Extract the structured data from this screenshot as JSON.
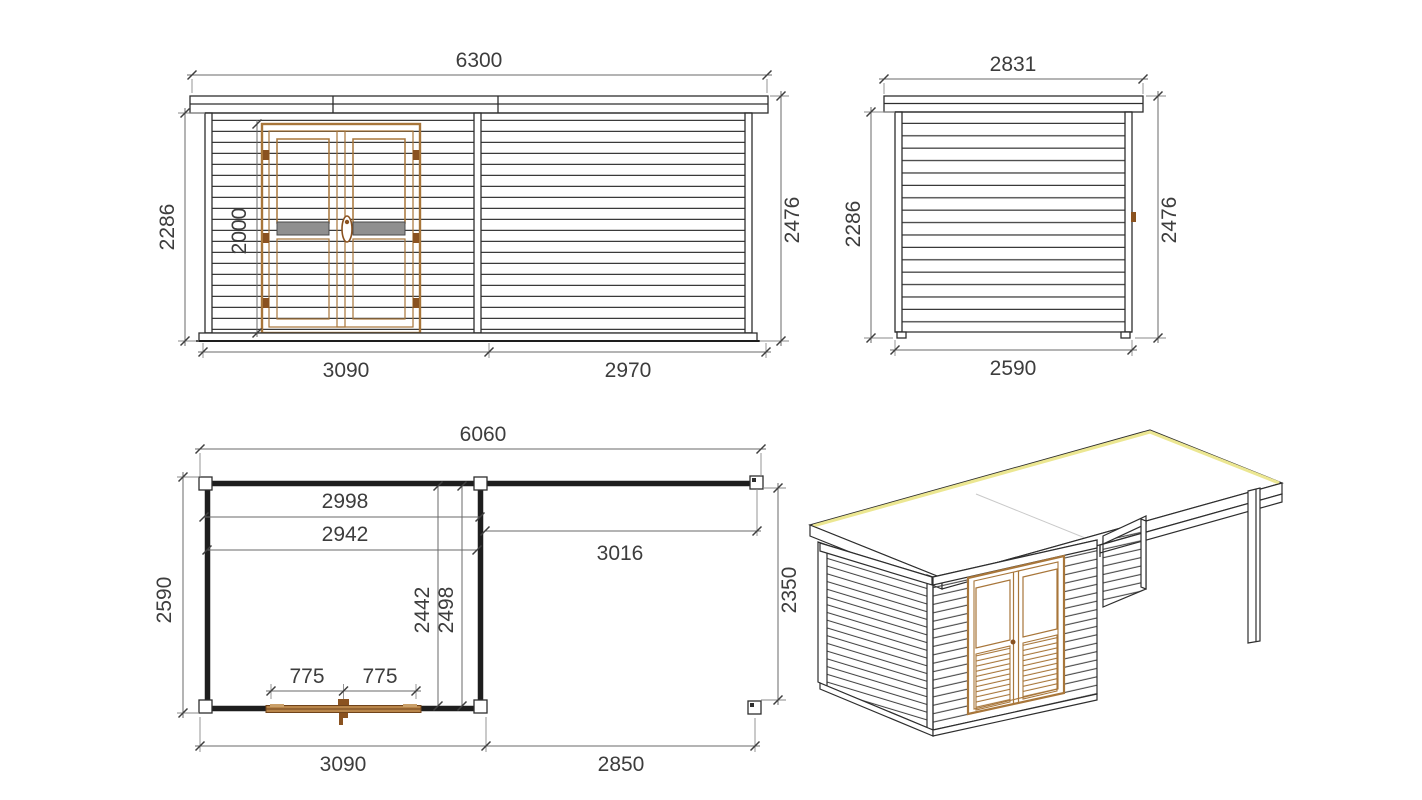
{
  "drawing_title": "Garden cabin with side canopy — dimension drawing",
  "views": {
    "front": {
      "label": "front-elevation",
      "overall_width": "6300",
      "wall_height": "2286",
      "door_height": "2000",
      "total_height": "2476",
      "cabin_width": "3090",
      "canopy_width": "2970"
    },
    "side": {
      "label": "side-elevation",
      "roof_depth": "2831",
      "wall_height": "2286",
      "total_height": "2476",
      "base_depth": "2590"
    },
    "plan": {
      "label": "floor-plan",
      "overall_width": "6060",
      "cabin_width_incl_wall": "2998",
      "cabin_inner_width": "2942",
      "canopy_inner_width": "3016",
      "depth": "2590",
      "cabin_inner_depth": "2442",
      "cabin_depth_incl_wall": "2498",
      "canopy_depth": "2350",
      "door_leaf_left": "775",
      "door_leaf_right": "775",
      "cabin_width_bottom": "3090",
      "canopy_width_bottom": "2850"
    },
    "iso": {
      "label": "isometric-view"
    }
  },
  "colors": {
    "background": "#ffffff",
    "line": "#2e2e2e",
    "dimension_text": "#3d3d3d",
    "door_wood": "#a8763a",
    "door_wood_dark": "#8a5220",
    "plan_door_fill": "#b8854a",
    "roof_edge_highlight": "#ece792",
    "door_rail_gray": "#8f8f8f"
  }
}
